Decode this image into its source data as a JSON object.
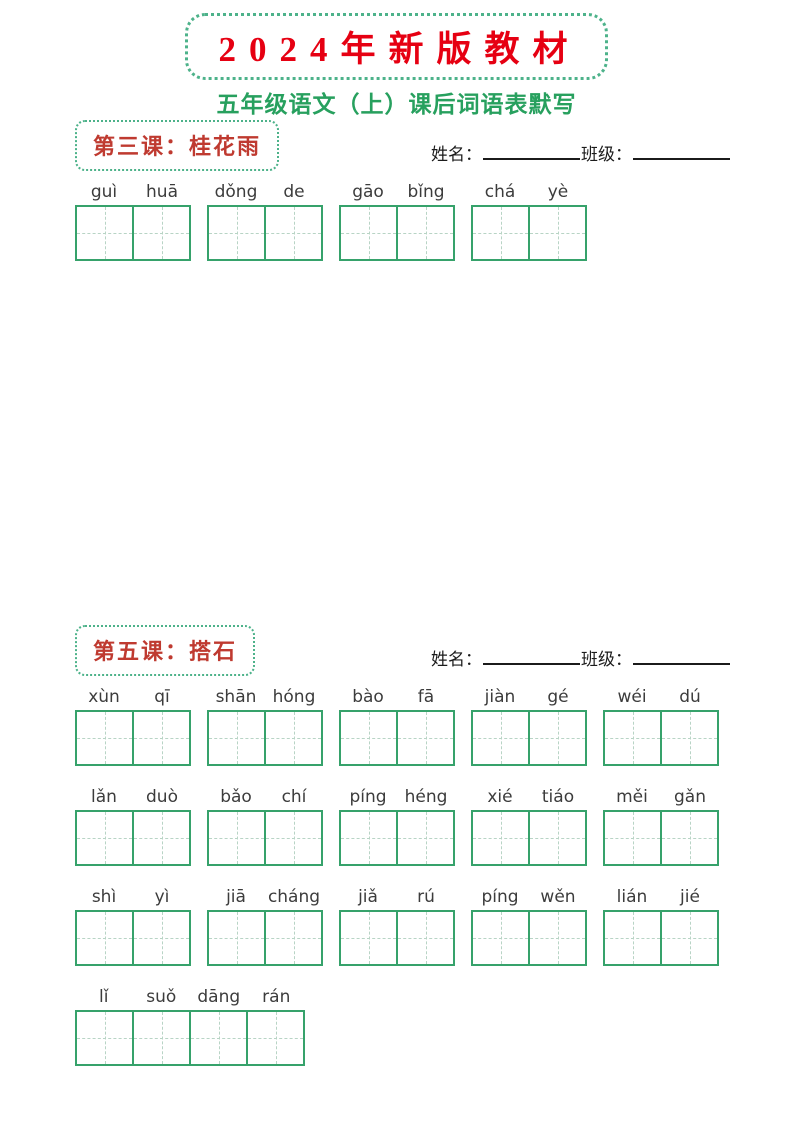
{
  "page": {
    "title": "2024年新版教材",
    "subtitle": "五年级语文（上）课后词语表默写"
  },
  "labels": {
    "name": "姓名：",
    "class": "班级："
  },
  "colors": {
    "title_red": "#e60012",
    "heading_red": "#bf3a30",
    "subtitle_green": "#27a05e",
    "box_green": "#4db28a",
    "grid_green": "#36a26b",
    "dash_green": "#b8d4c5",
    "ink": "#3c3c3c",
    "line_black": "#1b1b1b"
  },
  "sections": [
    {
      "heading": "第三课：桂花雨",
      "rows": [
        [
          [
            "guì",
            "huā"
          ],
          [
            "dǒng",
            "de"
          ],
          [
            "gāo",
            "bǐng"
          ],
          [
            "chá",
            "yè"
          ]
        ]
      ]
    },
    {
      "heading": "第五课：搭石",
      "rows": [
        [
          [
            "xùn",
            "qī"
          ],
          [
            "shān",
            "hóng"
          ],
          [
            "bào",
            "fā"
          ],
          [
            "jiàn",
            "gé"
          ],
          [
            "wéi",
            "dú"
          ]
        ],
        [
          [
            "lǎn",
            "duò"
          ],
          [
            "bǎo",
            "chí"
          ],
          [
            "píng",
            "héng"
          ],
          [
            "xié",
            "tiáo"
          ],
          [
            "měi",
            "gǎn"
          ]
        ],
        [
          [
            "shì",
            "yì"
          ],
          [
            "jiā",
            "cháng"
          ],
          [
            "jiǎ",
            "rú"
          ],
          [
            "píng",
            "wěn"
          ],
          [
            "lián",
            "jié"
          ]
        ],
        [
          [
            "lǐ",
            "suǒ",
            "dāng",
            "rán"
          ]
        ]
      ]
    }
  ]
}
